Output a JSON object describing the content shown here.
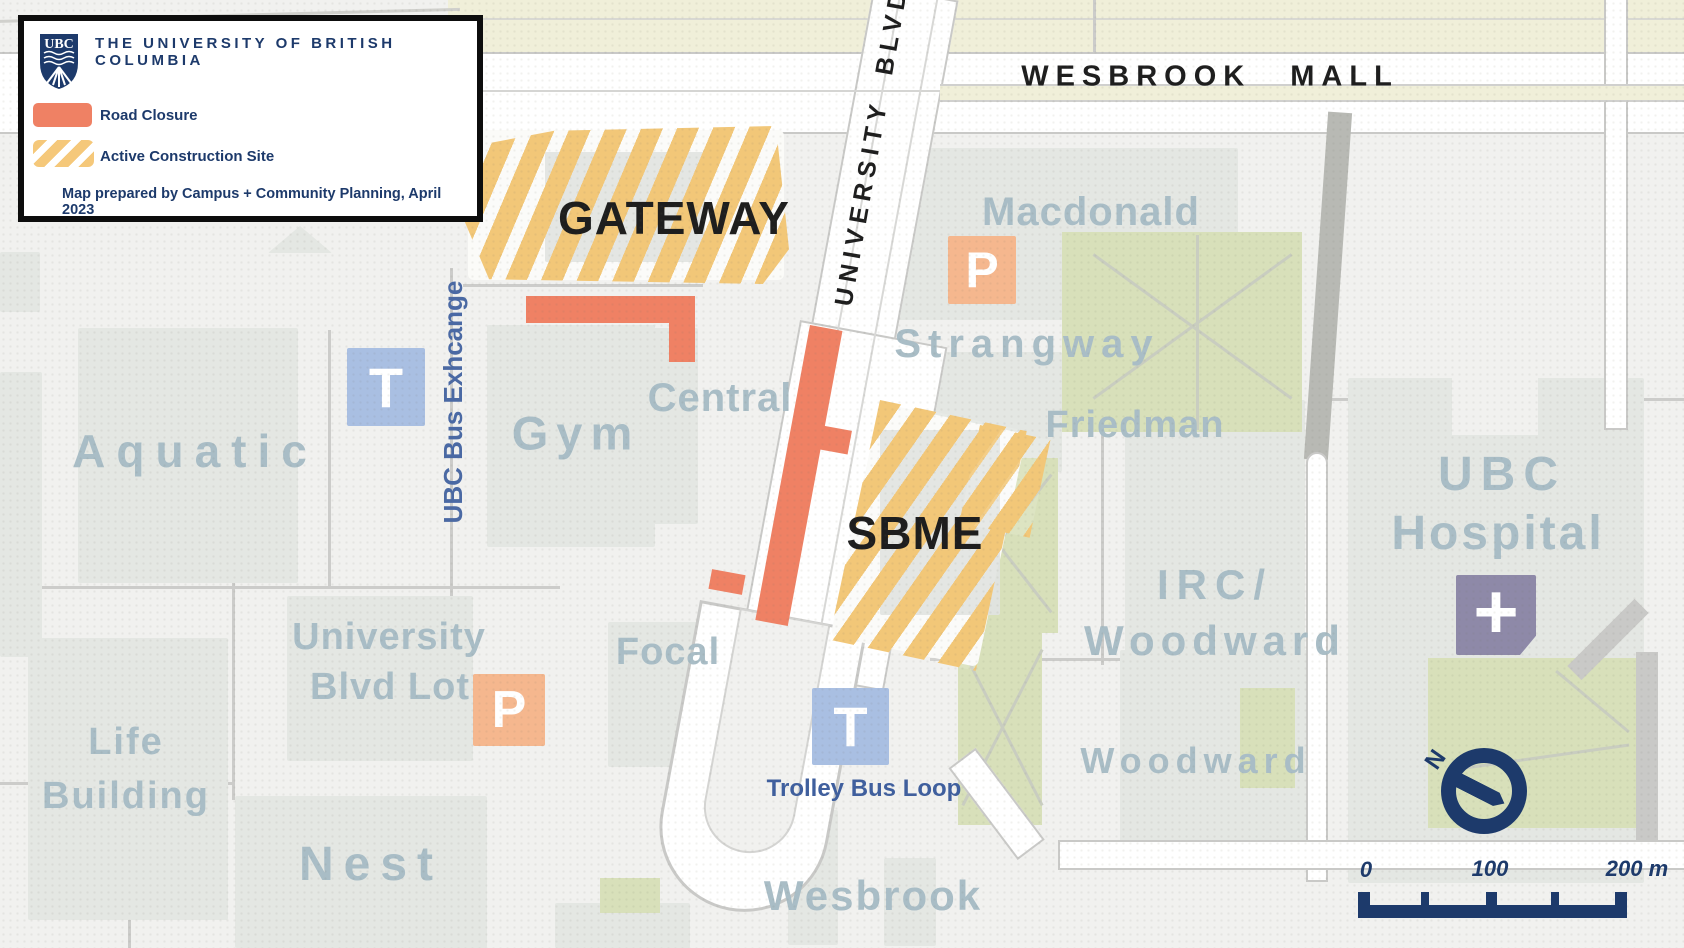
{
  "legend": {
    "logo_text": "UBC",
    "org": "THE UNIVERSITY OF BRITISH COLUMBIA",
    "road_closure_label": "Road Closure",
    "construction_label": "Active Construction Site",
    "credit": "Map prepared by Campus + Community Planning, April 2023"
  },
  "map": {
    "streets": {
      "wesbrook_mall": "WESBROOK MALL",
      "university_blvd": "UNIVERSITY BLVD"
    },
    "sites": {
      "gateway": "GATEWAY",
      "sbme": "SBME"
    },
    "buildings": {
      "aquatic": "Aquatic",
      "gym": "Gym",
      "central": "Central",
      "macdonald": "Macdonald",
      "strangway": "Strangway",
      "friedman": "Friedman",
      "irc_line1": "IRC/",
      "irc_line2": "Woodward",
      "hospital_line1": "UBC",
      "hospital_line2": "Hospital",
      "lot_line1": "University",
      "lot_line2": "Blvd Lot",
      "life_line1": "Life",
      "life_line2": "Building",
      "nest": "Nest",
      "focal": "Focal",
      "wesbrook": "Wesbrook",
      "woodward": "Woodward"
    },
    "transit": {
      "bus_exchange": "UBC Bus Exhcange",
      "trolley": "Trolley Bus Loop"
    },
    "icons": {
      "transit": "T",
      "parking": "P",
      "hospital": "+",
      "north": "N"
    },
    "scale": {
      "start": "0",
      "mid": "100",
      "end": "200 m"
    }
  },
  "colors": {
    "road_closure": "#EF8164",
    "construction": "#F2C778",
    "transit_icon": "#A9BFE2",
    "parking_icon": "#F5B78E",
    "hospital_icon": "#8E89A8",
    "navy": "#1D3A6B",
    "building_label": "#A9BDC6",
    "green_space": "#D8E0BA"
  }
}
